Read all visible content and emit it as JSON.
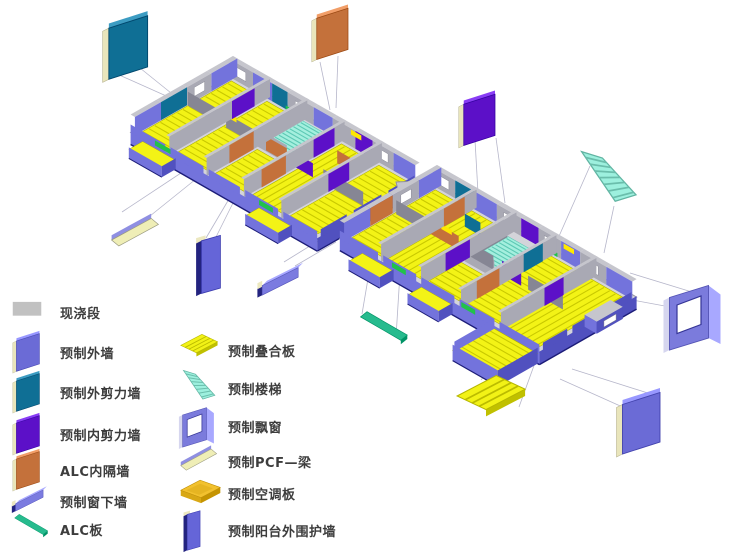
{
  "page": {
    "background": "#ffffff"
  },
  "legend": {
    "items": [
      {
        "id": "cast-in-place",
        "label": "现浇段",
        "color": "#c1c1c1",
        "icon": "flat"
      },
      {
        "id": "precast-exterior-wall",
        "label": "预制外墙",
        "color": "#6b6bd6",
        "icon": "wall"
      },
      {
        "id": "precast-exterior-shear-wall",
        "label": "预制外剪力墙",
        "color": "#0f6f95",
        "icon": "wall"
      },
      {
        "id": "precast-interior-shear-wall",
        "label": "预制内剪力墙",
        "color": "#5c10c8",
        "icon": "wall"
      },
      {
        "id": "alc-partition-wall",
        "label": "ALC内隔墙",
        "color": "#c4713b",
        "icon": "wall"
      },
      {
        "id": "precast-window-sill-wall",
        "label": "预制窗下墙",
        "color": "#7b7be0",
        "icon": "beam"
      },
      {
        "id": "alc-panel",
        "label": "ALC板",
        "color": "#27bb8e",
        "icon": "strip"
      },
      {
        "id": "precast-composite-slab",
        "label": "预制叠合板",
        "color": "#f2f216",
        "icon": "slab"
      },
      {
        "id": "precast-stair",
        "label": "预制楼梯",
        "color": "#9df0de",
        "icon": "stair"
      },
      {
        "id": "precast-bay-window",
        "label": "预制飘窗",
        "color": "#7b7bdc",
        "icon": "window"
      },
      {
        "id": "precast-pcf-beam",
        "label": "预制PCF—梁",
        "color": "#efeeb6",
        "icon": "panel"
      },
      {
        "id": "precast-ac-slab",
        "label": "预制空调板",
        "color": "#f2c12e",
        "icon": "tray"
      },
      {
        "id": "precast-balcony-enclosure-wall",
        "label": "预制阳台外围护墙",
        "color": "#6565d8",
        "icon": "tall"
      }
    ]
  },
  "diagram": {
    "building": {
      "wings": 2,
      "floor_slab_color": "#f3f316",
      "stair_color": "#a4efde",
      "exterior_band_color": "#7373dc",
      "cast_wall_color": "#a9a9b4"
    },
    "callouts": [
      {
        "id": "exterior-shear-wall",
        "legend_ref": 2
      },
      {
        "id": "alc-partition-wall",
        "legend_ref": 4
      },
      {
        "id": "interior-shear-wall",
        "legend_ref": 3
      },
      {
        "id": "stair",
        "legend_ref": 8
      },
      {
        "id": "bay-window",
        "legend_ref": 9
      },
      {
        "id": "exterior-wall",
        "legend_ref": 1
      },
      {
        "id": "composite-slab",
        "legend_ref": 7
      },
      {
        "id": "alc-panel",
        "legend_ref": 6
      },
      {
        "id": "pcf-beam",
        "legend_ref": 10
      },
      {
        "id": "balcony-enclosure-wall",
        "legend_ref": 12
      },
      {
        "id": "window-sill-wall",
        "legend_ref": 5
      }
    ]
  }
}
